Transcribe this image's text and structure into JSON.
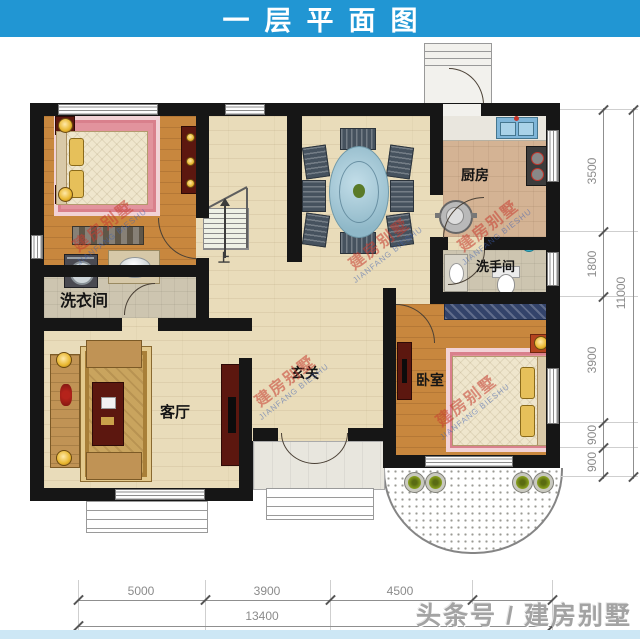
{
  "banner": {
    "title": "一层平面图"
  },
  "rooms": {
    "dining": "餐厅",
    "kitchen": "厨房",
    "bathroom": "洗手间",
    "laundry": "洗衣间",
    "living": "客厅",
    "foyer": "玄关",
    "bedroom": "卧室",
    "stairs_up": "上"
  },
  "dims": {
    "right": [
      "3500",
      "1800",
      "3900",
      "900",
      "900"
    ],
    "right_total": "11000",
    "bottom": [
      "5000",
      "3900",
      "4500"
    ],
    "bottom_total": "13400"
  },
  "watermarks": {
    "cn": "建房别墅",
    "en": "JIANFANG BIESHU",
    "footer": "头条号 / 建房别墅"
  },
  "colors": {
    "banner_blue": "#2196d3",
    "bottom_strip_blue": "#cde7f5",
    "wall_black": "#161616",
    "floor_cream": "#e9dcba",
    "floor_orange": "#c8873e",
    "floor_kitchen": "#d4b394",
    "floor_grey": "#cdc5b0",
    "rug_pink": "#e2939d",
    "dining_table_blue": "#a9cedd",
    "furniture_darkred": "#5c170f",
    "dim_text_grey": "#8b8b8b"
  }
}
